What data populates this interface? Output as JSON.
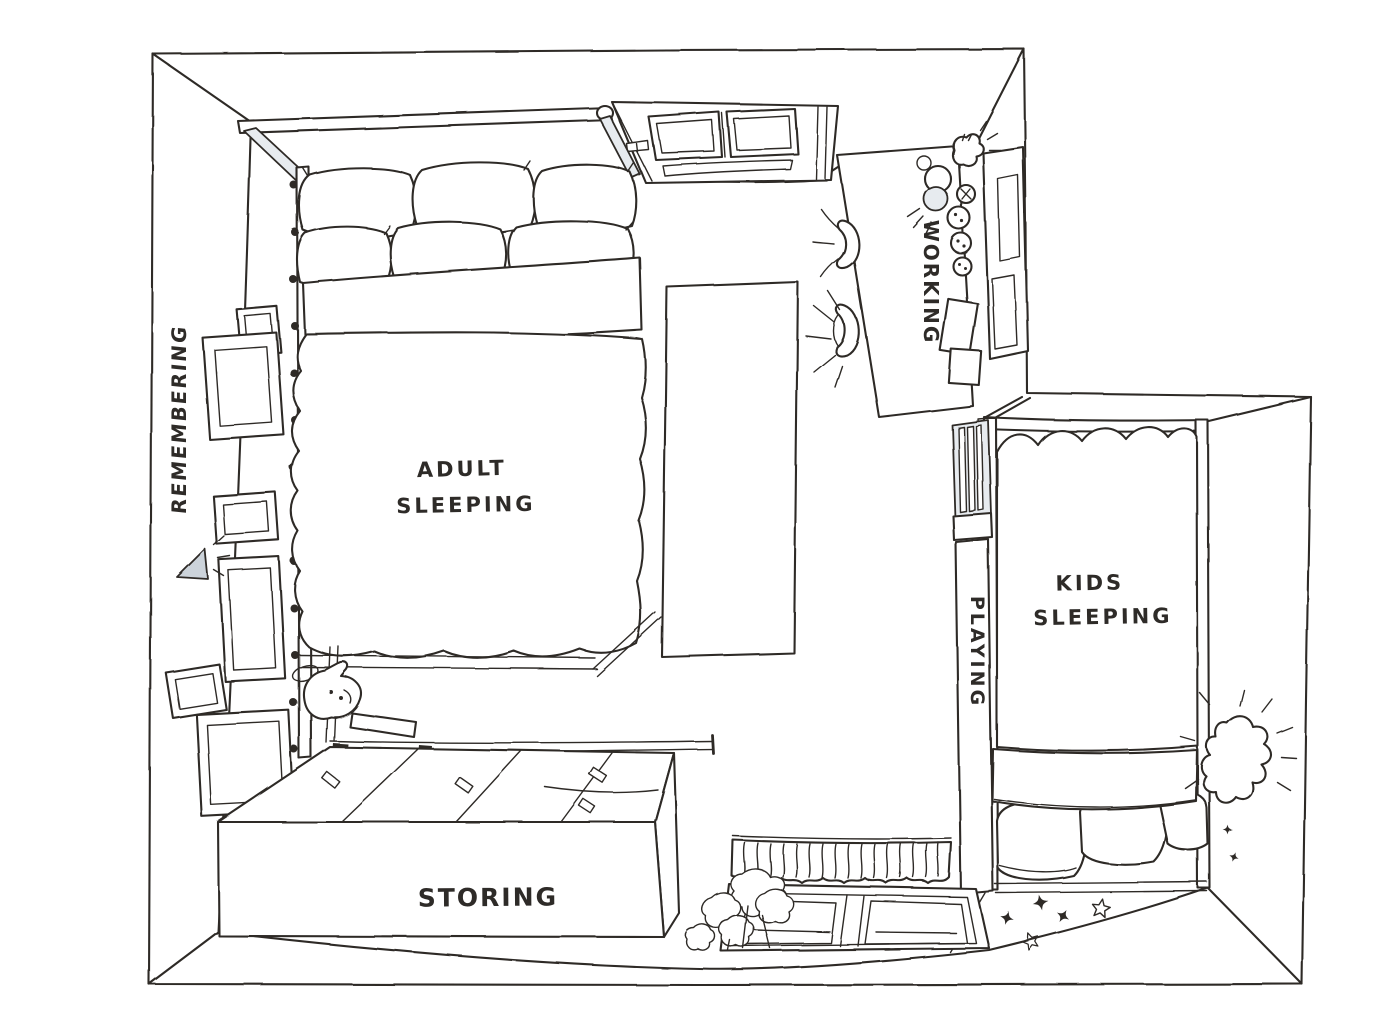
{
  "colors": {
    "ink": "#2e2b28",
    "paper": "#ffffff",
    "shade": "#ccd3da"
  },
  "zones": {
    "remembering": {
      "label": "REMEMBERING"
    },
    "adult_sleeping": {
      "line1": "ADULT",
      "line2": "SLEEPING"
    },
    "working": {
      "label": "WORKING"
    },
    "kids_sleeping": {
      "line1": "KIDS",
      "line2": "SLEEPING"
    },
    "playing": {
      "label": "PLAYING"
    },
    "storing": {
      "label": "STORING"
    }
  },
  "icons": {
    "star": "✦",
    "wall_lamp": "glow-wedge",
    "reading_lamp": "glow-wedge",
    "desk_lamp": "glow-circle",
    "night_lamp": "glow-cloud",
    "plant": "bush-scribble",
    "pet": "dog-sketch"
  }
}
